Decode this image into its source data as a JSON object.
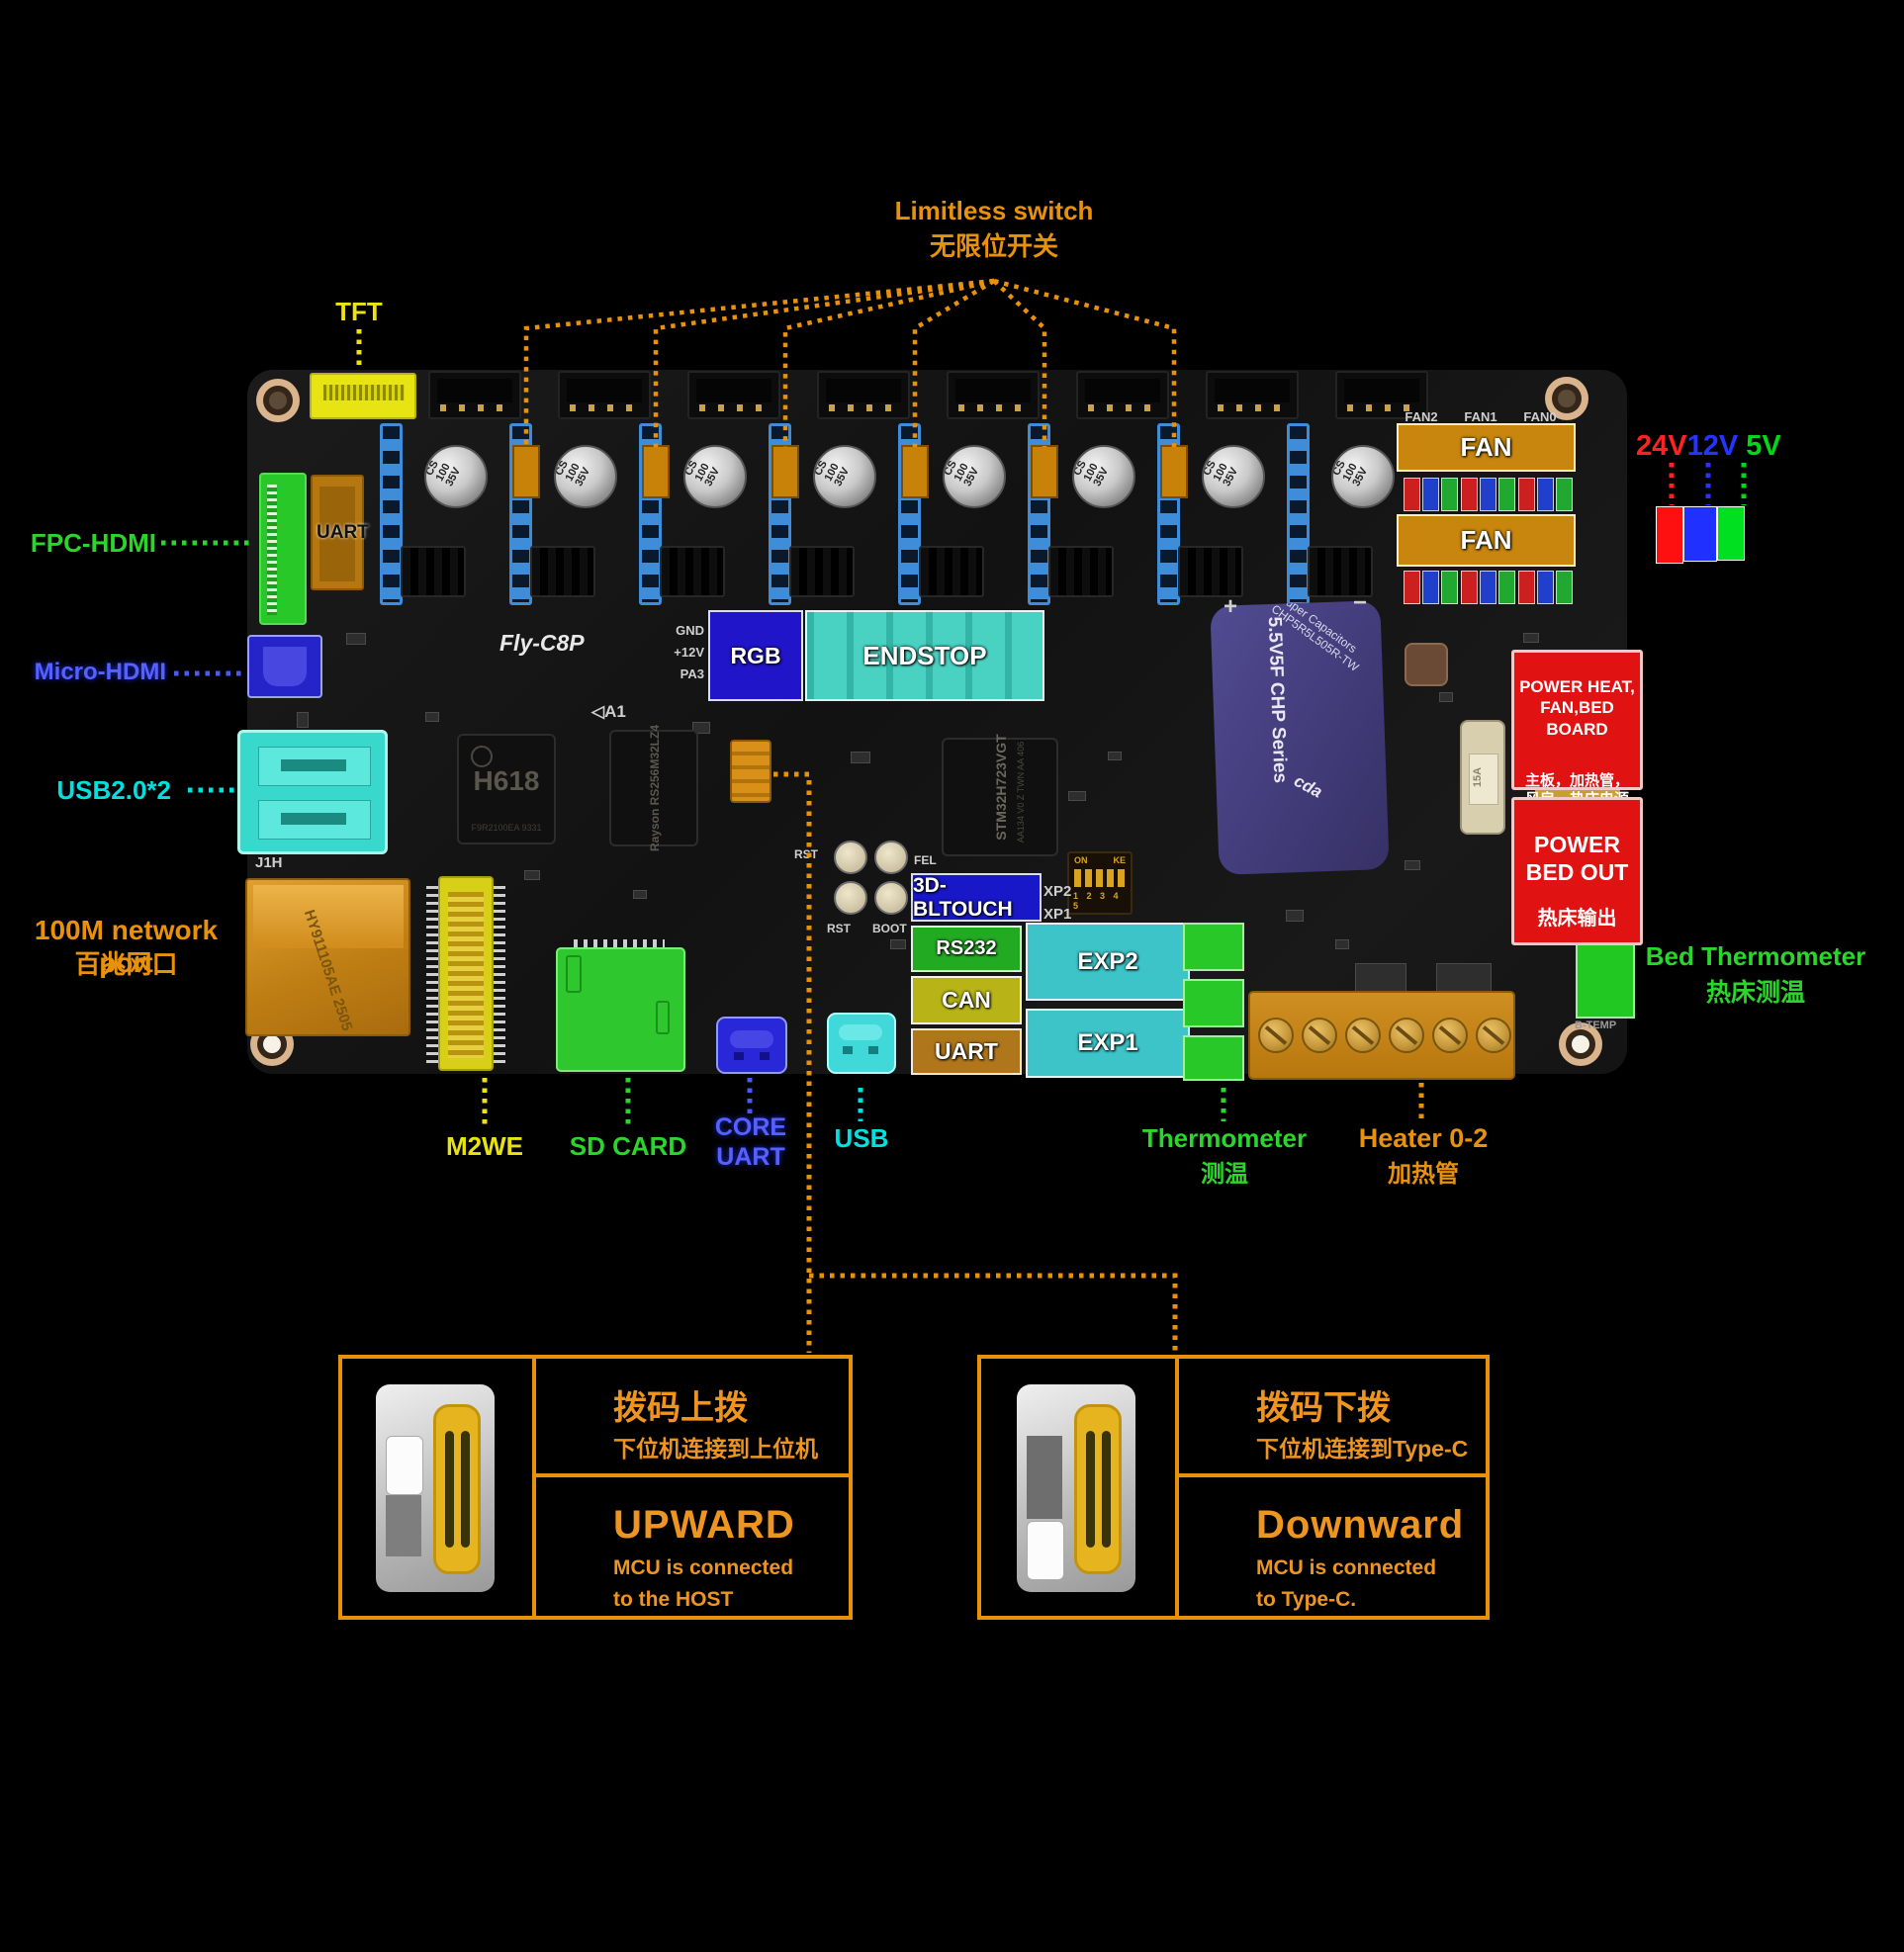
{
  "annotations": {
    "limitless_switch_en": "Limitless switch",
    "limitless_switch_zh": "无限位开关",
    "tft": "TFT",
    "fpc_hdmi": "FPC-HDMI",
    "micro_hdmi": "Micro-HDMI",
    "usb2": "USB2.0*2",
    "network_en": "100M network port",
    "network_zh": "百兆网口",
    "m2we": "M2WE",
    "sd_card": "SD CARD",
    "core_uart_line1": "CORE",
    "core_uart_line2": "UART",
    "usb": "USB",
    "thermometer_en": "Thermometer",
    "thermometer_zh": "测温",
    "heater_en": "Heater 0-2",
    "heater_zh": "加热管",
    "bed_thermometer_en": "Bed Thermometer",
    "bed_thermometer_zh": "热床测温"
  },
  "voltage_legend": {
    "v24": "24V",
    "v12": "12V",
    "v5": "5V",
    "colors": {
      "v24": "#ff2222",
      "v12": "#2535ff",
      "v5": "#00d818"
    }
  },
  "board": {
    "name": "Fly-C8P",
    "a1_mark": "◁A1",
    "j1h": "J1H",
    "b_temp": "B-TEMP",
    "fan_ports": [
      "FAN2",
      "FAN1",
      "FAN0"
    ],
    "cap_label": "CS\n100\n35V",
    "gnd": "GND",
    "v12_pin": "+12V",
    "pa3": "PA3",
    "rst": "RST",
    "fel": "FEL",
    "boot": "BOOT",
    "dip_on": "ON",
    "dip_ke": "KE",
    "dip_numbers": "1 2 3 4 5",
    "xp2": "XP2",
    "xp1": "XP1",
    "plus": "+",
    "minus": "−",
    "uart_connector": "UART",
    "overlays": {
      "rgb": "RGB",
      "endstop": "ENDSTOP",
      "fan": "FAN",
      "bltouch": "3D-BLTOUCH",
      "rs232": "RS232",
      "can": "CAN",
      "uart": "UART",
      "exp2": "EXP2",
      "exp1": "EXP1"
    },
    "chips": {
      "soc": "H618",
      "soc_code": "F9R2100EA 9331",
      "ram": "Rayson RS256M32LZ4",
      "mcu": "STM32H723VGT",
      "mcu_code": "AA134 V0 Z TWN AA 406",
      "supercap_series": "5.5V5F CHP Series",
      "supercap_maker": "Super Capacitors CHP5R5L505R-TW",
      "supercap_brand": "cda",
      "fuse": "15A",
      "ethernet_code": "HY911105AE 2505"
    }
  },
  "power_panels": {
    "heat_en": "POWER HEAT,\nFAN,BED\nBOARD",
    "heat_zh": "主板，加热管，\n风扇，热床电源",
    "bed_en": "POWER\nBED OUT",
    "bed_zh": "热床输出"
  },
  "switch_panels": {
    "upward": {
      "zh_title": "拨码上拨",
      "zh_sub": "下位机连接到上位机",
      "en_title": "UPWARD",
      "en_line1": "MCU is connected",
      "en_line2": "to the HOST"
    },
    "downward": {
      "zh_title": "拨码下拨",
      "zh_sub": "下位机连接到Type-C",
      "en_title": "Downward",
      "en_line1": "MCU is connected",
      "en_line2": "to Type-C."
    }
  }
}
